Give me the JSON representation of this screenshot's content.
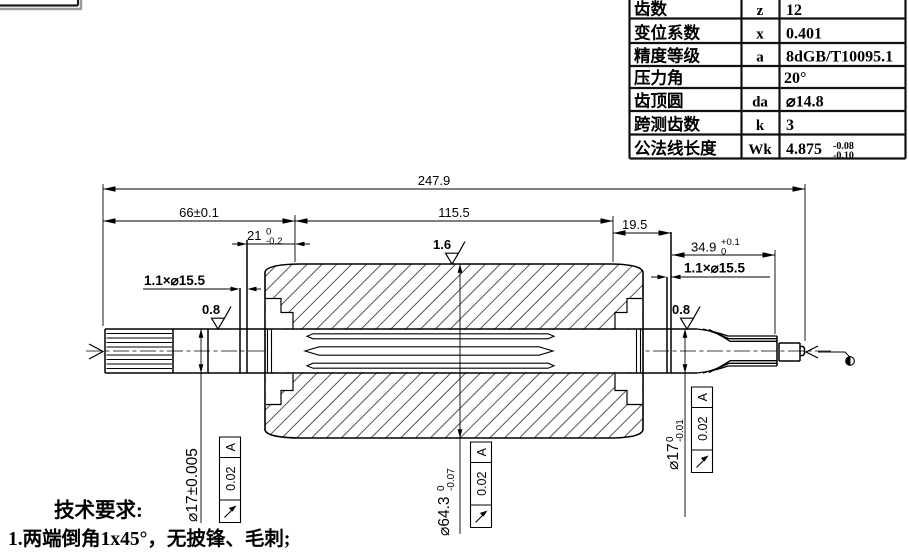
{
  "colors": {
    "line": "#000000",
    "background": "#ffffff",
    "shadow": "#9a9a9a"
  },
  "gear_table": {
    "rows": [
      {
        "name": "齿数",
        "symbol": "z",
        "value": "12"
      },
      {
        "name": "变位系数",
        "symbol": "x",
        "value": "0.401"
      },
      {
        "name": "精度等级",
        "symbol": "a",
        "value": "8dGB/T10095.1"
      },
      {
        "name": "压力角",
        "symbol": "",
        "value": "20°"
      },
      {
        "name": "齿顶圆",
        "symbol": "da",
        "value": "⌀14.8"
      },
      {
        "name": "跨测齿数",
        "symbol": "k",
        "value": "3"
      },
      {
        "name": "公法线长度",
        "symbol": "Wk",
        "value": "4.875",
        "tol_up": "-0.08",
        "tol_low": "-0.10"
      }
    ]
  },
  "dims": {
    "overall": "247.9",
    "left_len": "66±0.1",
    "mid_len": "115.5",
    "step": {
      "v": "21",
      "up": "0",
      "low": "-0.2"
    },
    "right_step": "19.5",
    "tail": {
      "v": "34.9",
      "up": "+0.1",
      "low": "0"
    },
    "groove_left": "1.1×⌀15.5",
    "groove_right": "1.1×⌀15.5",
    "dia_left": "⌀17±0.005",
    "dia_core": {
      "v": "⌀64.3",
      "up": "0",
      "low": "-0.07"
    },
    "dia_right": {
      "v": "⌀17",
      "up": "0",
      "low": "-0.01"
    }
  },
  "roughness": {
    "left": "0.8",
    "core": "1.6",
    "right": "0.8"
  },
  "frames": [
    {
      "symbol": "↗",
      "tolerance": "0.02",
      "datum": "A"
    },
    {
      "symbol": "↗",
      "tolerance": "0.02",
      "datum": "A"
    },
    {
      "symbol": "↗",
      "tolerance": "0.02",
      "datum": "A"
    }
  ],
  "notes": {
    "title": "技术要求:",
    "items": [
      "1.两端倒角1x45°，无披锋、毛刺;"
    ]
  }
}
